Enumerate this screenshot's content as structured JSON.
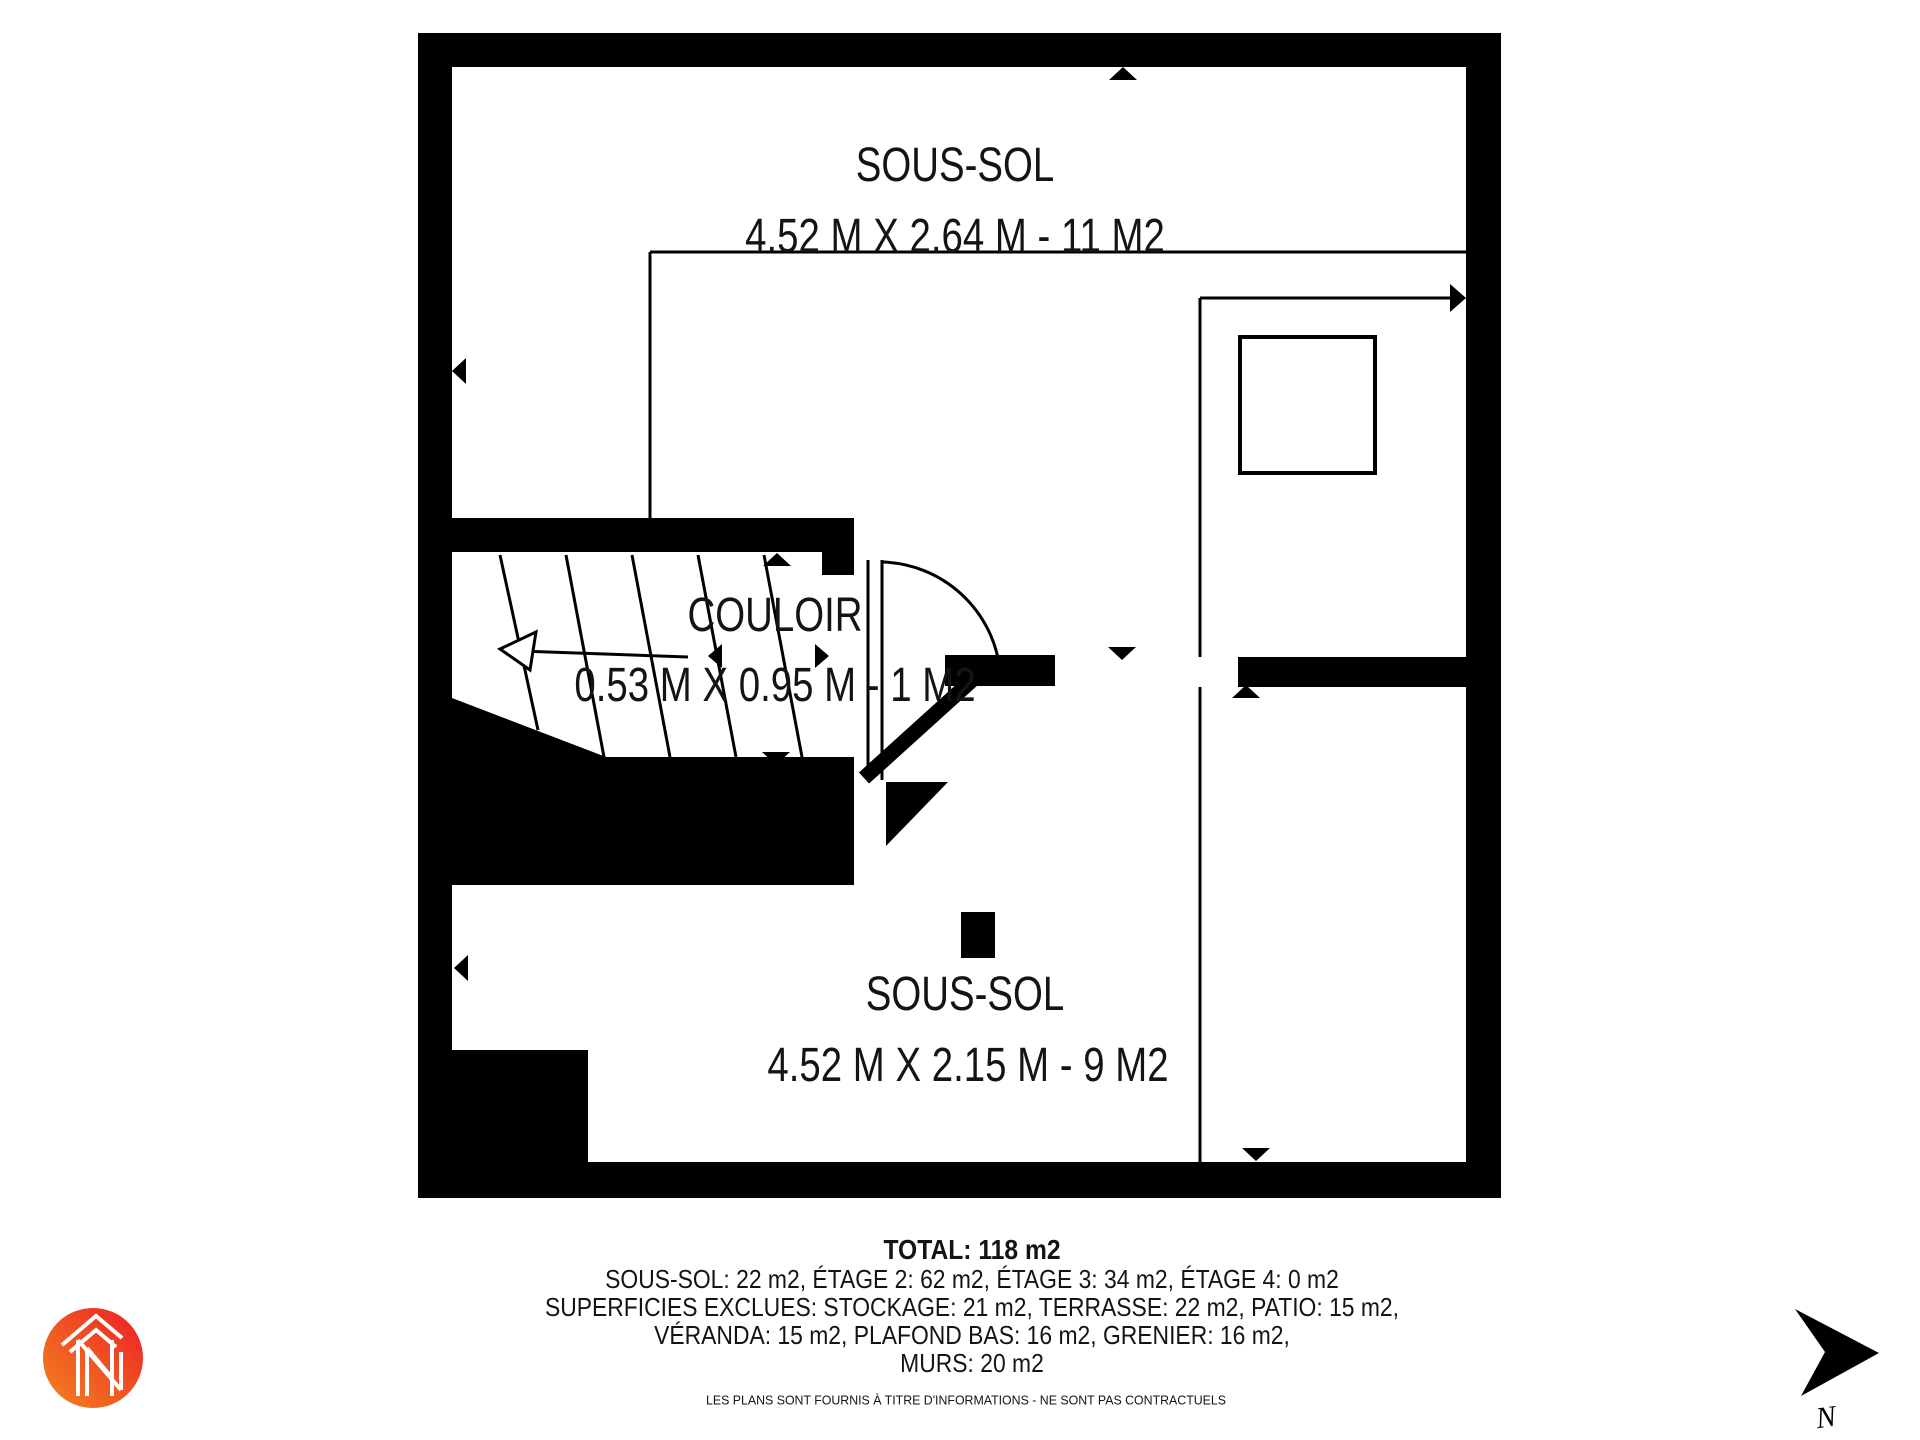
{
  "floorplan": {
    "rooms": [
      {
        "name": "SOUS-SOL",
        "dims": "4.52 M X 2.64 M - 11 M2"
      },
      {
        "name": "COULOIR",
        "dims": "0.53 M X 0.95 M - 1 M2"
      },
      {
        "name": "SOUS-SOL",
        "dims": "4.52 M X 2.15 M - 9 M2"
      }
    ]
  },
  "summary": {
    "total": "TOTAL: 118 m2",
    "floors": "SOUS-SOL: 22 m2, ÉTAGE 2: 62 m2, ÉTAGE 3: 34 m2, ÉTAGE 4: 0 m2",
    "excluded_1": "SUPERFICIES EXCLUES: STOCKAGE: 21 m2, TERRASSE: 22 m2, PATIO: 15 m2,",
    "excluded_2": "VÉRANDA: 15 m2, PLAFOND BAS: 16 m2, GRENIER: 16 m2,",
    "walls": "MURS: 20 m2"
  },
  "disclaimer": "LES PLANS SONT FOURNIS À TITRE D'INFORMATIONS - NE SONT PAS CONTRACTUELS",
  "compass": {
    "label": "N"
  },
  "logo": {
    "name": "agency-house-n-logo"
  },
  "colors": {
    "wall": "#000000",
    "background": "#ffffff",
    "text": "#141414",
    "logo_orange": "#F5841F",
    "logo_red": "#EC1C24"
  }
}
